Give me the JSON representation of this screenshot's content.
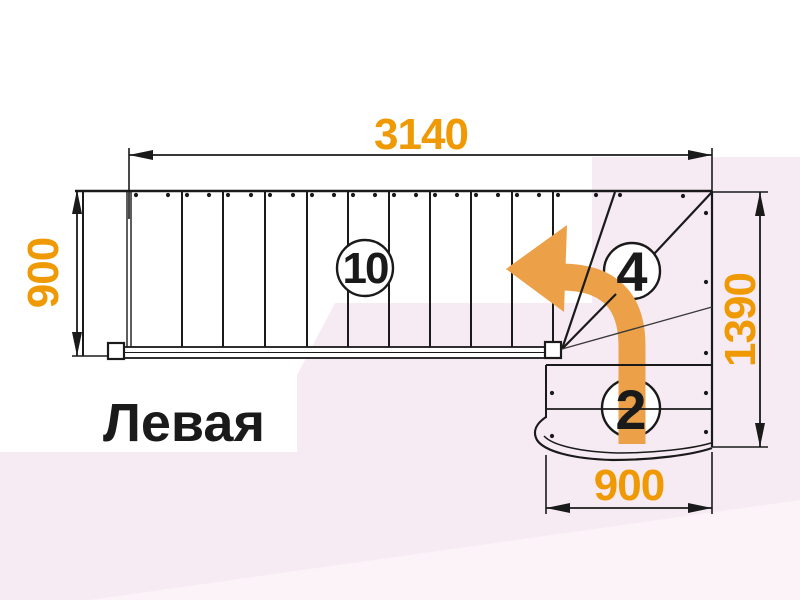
{
  "title": {
    "text": "Левая"
  },
  "dimensions": {
    "top_width": "3140",
    "left_height": "900",
    "right_height": "1390",
    "bottom_width": "900"
  },
  "flights": {
    "straight_steps": "10",
    "winder_steps": "4",
    "bottom_steps": "2"
  },
  "colors": {
    "dimension_text": "#EF9A05",
    "turn_arrow": "#ECA149",
    "linework": "#1a1a1a",
    "background_tint": "#f7ebf3",
    "background_tint_light": "#fbf3f8"
  }
}
